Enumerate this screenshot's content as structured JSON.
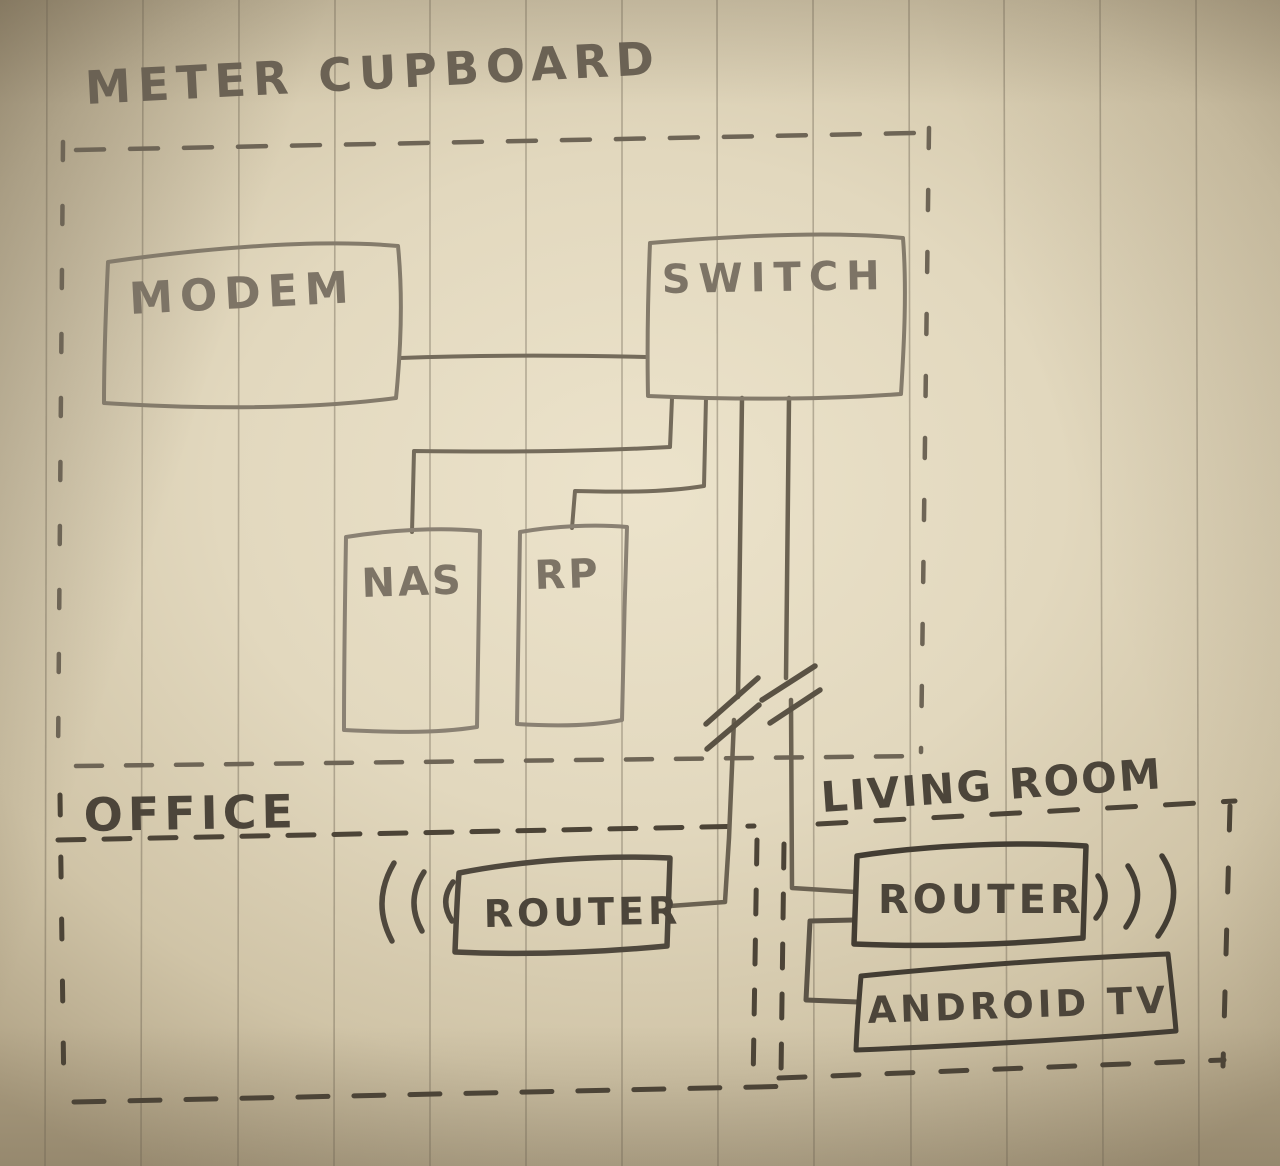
{
  "rooms": {
    "meter_cupboard": {
      "label": "METER CUPBOARD"
    },
    "office": {
      "label": "OFFICE"
    },
    "living_room": {
      "label": "LIVING ROOM"
    }
  },
  "nodes": {
    "modem": {
      "label": "MODEM",
      "room": "meter_cupboard"
    },
    "switch": {
      "label": "SWITCH",
      "room": "meter_cupboard"
    },
    "nas": {
      "label": "NAS",
      "room": "meter_cupboard"
    },
    "rp": {
      "label": "RP",
      "room": "meter_cupboard"
    },
    "office_router": {
      "label": "ROUTER",
      "room": "office",
      "wifi": true
    },
    "living_room_router": {
      "label": "ROUTER",
      "room": "living_room",
      "wifi": true
    },
    "android_tv": {
      "label": "ANDROID TV",
      "room": "living_room"
    }
  },
  "icons": {
    "office_router_wifi": "wifi-waves-left",
    "living_room_router_wifi": "wifi-waves-right",
    "wall_pass_through": "double-slash-cable-break"
  },
  "connections": [
    {
      "from": "modem",
      "to": "switch",
      "through_wall": false
    },
    {
      "from": "switch",
      "to": "nas",
      "through_wall": false
    },
    {
      "from": "switch",
      "to": "rp",
      "through_wall": false
    },
    {
      "from": "switch",
      "to": "office_router",
      "through_wall": true
    },
    {
      "from": "switch",
      "to": "living_room_router",
      "through_wall": true
    },
    {
      "from": "living_room_router",
      "to": "android_tv",
      "through_wall": false
    }
  ],
  "style": {
    "paper_color": "#e2d8be",
    "pencil_light": "#7d7466",
    "pencil_medium": "#6b6254",
    "pencil_dark": "#4c453a",
    "boundary_style": "dashed"
  }
}
